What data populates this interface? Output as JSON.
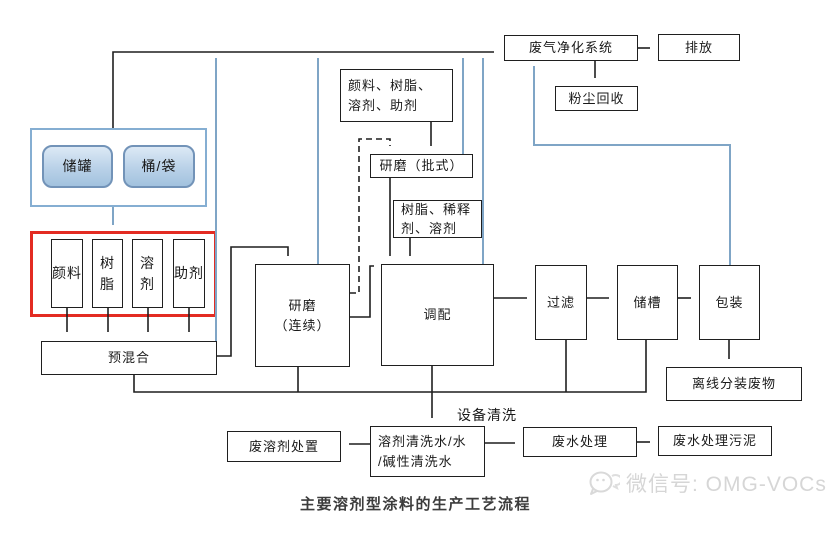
{
  "diagram": {
    "caption": "主要溶剂型涂料的生产工艺流程",
    "watermark_text": "微信号: OMG-VOCs",
    "labels": {
      "equipment_cleaning": "设备清洗"
    },
    "colors": {
      "flow_line": "#1f1f1f",
      "waste_gas_line": "#7fa5c6",
      "raw_material_highlight_border": "#e32b22",
      "storage_group_border": "#85aed2",
      "storage_box_border": "#7293b8",
      "storage_box_fill": "#b9d1e8"
    },
    "nodes": {
      "tank": "储罐",
      "barrel": "桶/袋",
      "pigment": "颜料",
      "resin": "树脂",
      "solvent": "溶剂",
      "additive": "助剂",
      "premix": "预混合",
      "grinding_continuous": "研磨\n（连续）",
      "materials_top": "颜料、树脂、溶剂、助剂",
      "grinding_batch": "研磨（批式）",
      "materials_mid": "树脂、稀释剂、溶剂",
      "blending": "调配",
      "filtering": "过滤",
      "storage_tank": "储槽",
      "packaging": "包装",
      "gas_purification": "废气净化系统",
      "emission": "排放",
      "dust_recovery": "粉尘回收",
      "offline_packaging_waste": "离线分装废物",
      "cleaning_water": "溶剂清洗水/水\n/碱性清洗水",
      "waste_solvent_disposal": "废溶剂处置",
      "wastewater_treatment": "废水处理",
      "wastewater_sludge": "废水处理污泥"
    }
  }
}
